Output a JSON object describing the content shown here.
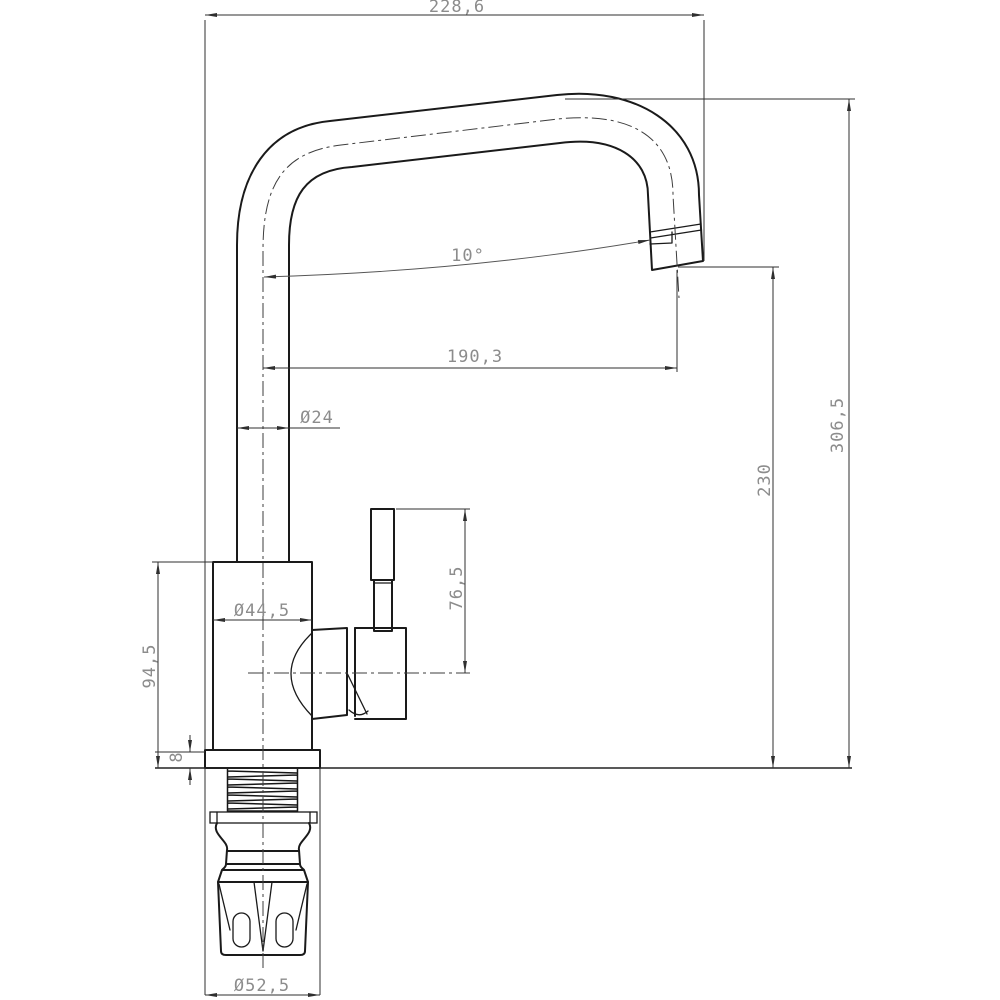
{
  "drawing": {
    "title": "faucet-technical-drawing",
    "view": "side elevation",
    "dimensions": {
      "overall_width": "228,6",
      "spout_angle": "10°",
      "outlet_reach": "190,3",
      "spout_tube_diameter": "Ø24",
      "overall_height": "306,5",
      "outlet_height": "230",
      "handle_height": "76,5",
      "body_diameter": "Ø44,5",
      "body_height": "94,5",
      "flange_thickness": "8",
      "flange_diameter": "Ø52,5"
    }
  },
  "colors": {
    "background": "#ffffff",
    "outline": "#1a1a1a",
    "thin": "#2f2f2f",
    "center": "#3d3d3d",
    "text": "#8c8c8c"
  }
}
